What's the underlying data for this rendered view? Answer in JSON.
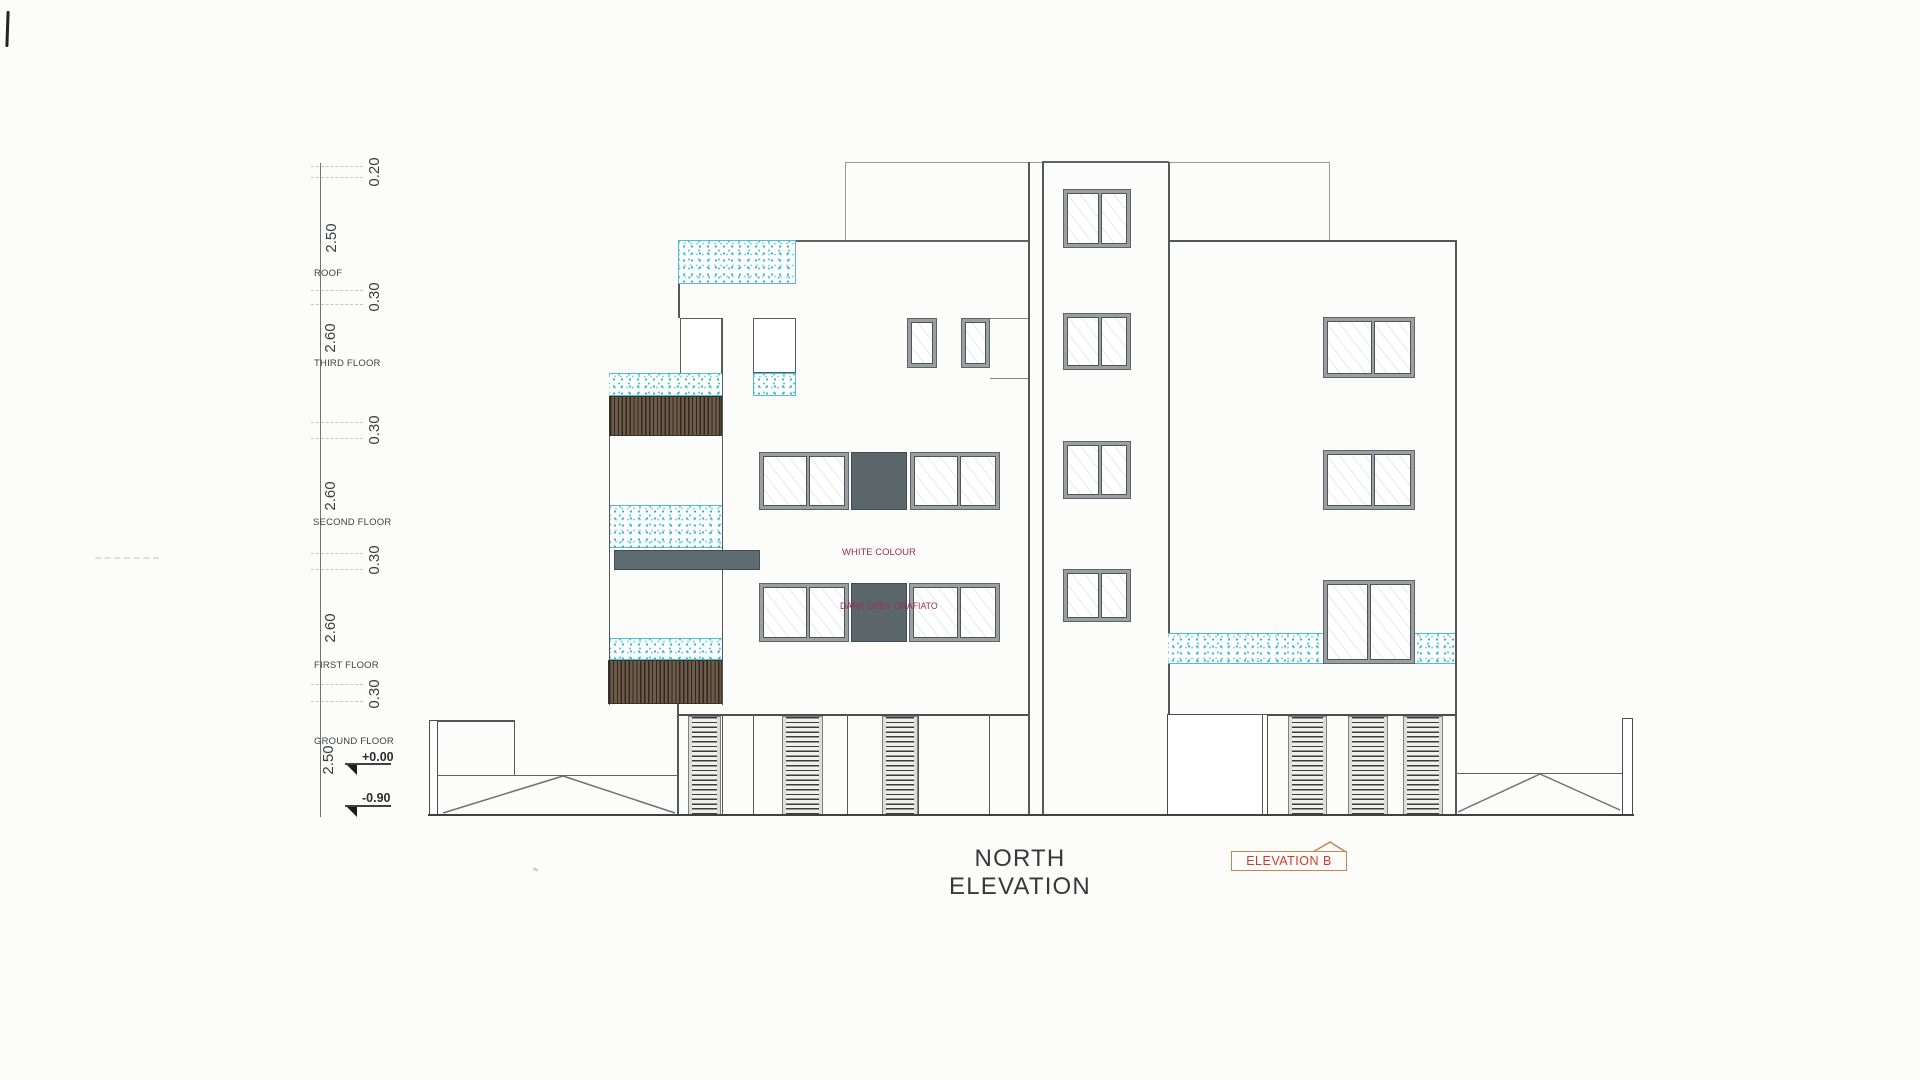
{
  "title": {
    "label": "NORTH ELEVATION",
    "tag": "ELEVATION B"
  },
  "dimensions": {
    "values": [
      "0.20",
      "2.50",
      "0.30",
      "2.60",
      "0.30",
      "2.60",
      "0.30",
      "2.60",
      "0.30",
      "2.50"
    ]
  },
  "floors": {
    "labels": [
      "ROOF",
      "THIRD FLOOR",
      "SECOND FLOOR",
      "FIRST FLOOR",
      "GROUND FLOOR"
    ]
  },
  "levels": {
    "upper": "+0.00",
    "lower": "-0.90"
  },
  "annotations": {
    "wall_finish": "WHITE COLOUR",
    "panel_finish": "DARK GREY GRAFIATO"
  },
  "colors": {
    "stipple_cyan": "#3ab5cc",
    "timber_brown": "#6a5847",
    "panel_grey": "#5b666b",
    "annotation_red": "#9c2d50",
    "tag_border": "#c8854e",
    "tag_text": "#d03a2c"
  }
}
